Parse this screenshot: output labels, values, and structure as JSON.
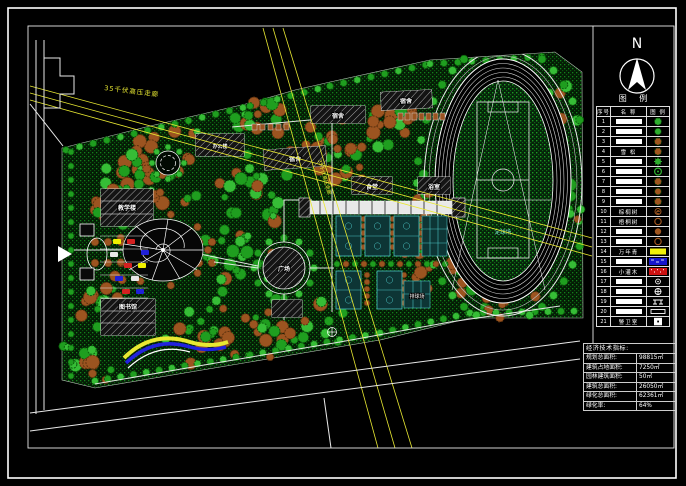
{
  "north": {
    "label": "N"
  },
  "legend": {
    "title": "图 例",
    "columns": [
      "序号",
      "名 称",
      "图 例"
    ],
    "rows": [
      {
        "num": "1",
        "name": "",
        "block": true,
        "symbol": "tree-cloud",
        "color": "#2fae2f"
      },
      {
        "num": "2",
        "name": "",
        "block": true,
        "symbol": "tree-round",
        "color": "#2fae2f"
      },
      {
        "num": "3",
        "name": "",
        "block": true,
        "symbol": "tree-cloud",
        "color": "#a0561f"
      },
      {
        "num": "4",
        "name": "雪 松",
        "block": false,
        "symbol": "tree-cloud",
        "color": "#a0561f"
      },
      {
        "num": "5",
        "name": "",
        "block": true,
        "symbol": "tree-star",
        "color": "#2fae2f"
      },
      {
        "num": "6",
        "name": "",
        "block": true,
        "symbol": "tree-ring",
        "color": "#2fae2f"
      },
      {
        "num": "7",
        "name": "",
        "block": true,
        "symbol": "tree-cloud",
        "color": "#a0561f"
      },
      {
        "num": "8",
        "name": "",
        "block": true,
        "symbol": "tree-round",
        "color": "#a0561f"
      },
      {
        "num": "9",
        "name": "",
        "block": true,
        "symbol": "tree-cloud",
        "color": "#a0561f"
      },
      {
        "num": "10",
        "name": "棕榈树",
        "block": false,
        "symbol": "circle-e",
        "color": "#a0561f"
      },
      {
        "num": "11",
        "name": "梧桐树",
        "block": false,
        "symbol": "circle-open",
        "color": "#a0561f"
      },
      {
        "num": "12",
        "name": "",
        "block": true,
        "symbol": "circle-fill",
        "color": "#a0561f"
      },
      {
        "num": "13",
        "name": "",
        "block": true,
        "symbol": "circle-open",
        "color": "#a0561f"
      },
      {
        "num": "14",
        "name": "万年青",
        "block": false,
        "symbol": "rect-fill",
        "color": "#f2f20a"
      },
      {
        "num": "15",
        "name": "",
        "block": true,
        "symbol": "rect-water",
        "color": "#1515cc"
      },
      {
        "num": "16",
        "name": "小灌木",
        "block": false,
        "symbol": "rect-hatch",
        "color": "#cc1111"
      },
      {
        "num": "17",
        "name": "",
        "block": true,
        "symbol": "lamp",
        "color": "#ffffff"
      },
      {
        "num": "18",
        "name": "",
        "block": true,
        "symbol": "lamp-cross",
        "color": "#ffffff"
      },
      {
        "num": "19",
        "name": "",
        "block": true,
        "symbol": "bench",
        "color": "#ffffff"
      },
      {
        "num": "20",
        "name": "",
        "block": true,
        "symbol": "bar",
        "color": "#ffffff"
      },
      {
        "num": "21",
        "name": "警卫室",
        "block": false,
        "symbol": "square-dot",
        "color": "#ffffff"
      }
    ]
  },
  "indicators": {
    "title": "经济技术指标:",
    "rows": [
      {
        "label": "规划总面积:",
        "value": "98815㎡"
      },
      {
        "label": "建筑占地面积:",
        "value": "7250㎡"
      },
      {
        "label": "园林建筑面积:",
        "value": "50㎡"
      },
      {
        "label": "建筑总面积:",
        "value": "26050㎡"
      },
      {
        "label": "绿化总面积:",
        "value": "62361㎡"
      },
      {
        "label": "绿化率:",
        "value": "64%"
      }
    ]
  },
  "plan": {
    "labels": {
      "power_corridor": "35千伏高压走廊",
      "dorm": "宿舍",
      "canteen": "食堂",
      "bath": "浴室",
      "office": "办公楼",
      "teaching": "教学楼",
      "library": "图书馆",
      "plaza": "广场",
      "volleyball": "排球场",
      "soccer": "足球场"
    },
    "colors": {
      "grass": "#0e6f12",
      "tree_green": "#27a327",
      "tree_brown": "#9c5420",
      "power_line": "#e8e832",
      "court": "#4ac2c2",
      "accent_yellow": "#f2f20a",
      "accent_blue": "#1515cc",
      "accent_red": "#cc1111"
    }
  }
}
